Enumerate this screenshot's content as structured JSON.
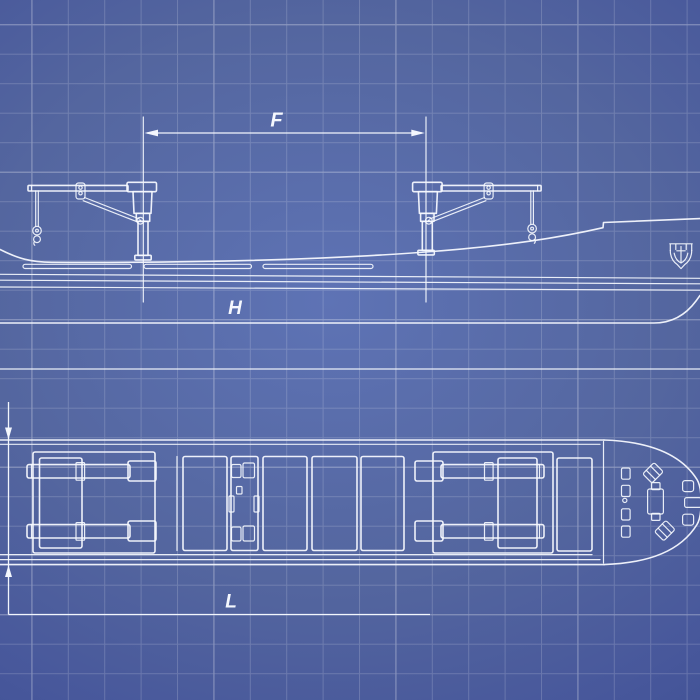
{
  "blueprint": {
    "labels": {
      "crane_spacing": "F",
      "hull_depth": "H",
      "hull_length": "L"
    },
    "colors": {
      "background_center": "#5e73b5",
      "background_edge": "#33438a",
      "line": "#f5f8fe",
      "grid_minor": "rgba(255,255,255,0.17)",
      "grid_major": "rgba(255,255,255,0.16)"
    },
    "icons": [
      {
        "name": "anchor-icon"
      }
    ]
  }
}
